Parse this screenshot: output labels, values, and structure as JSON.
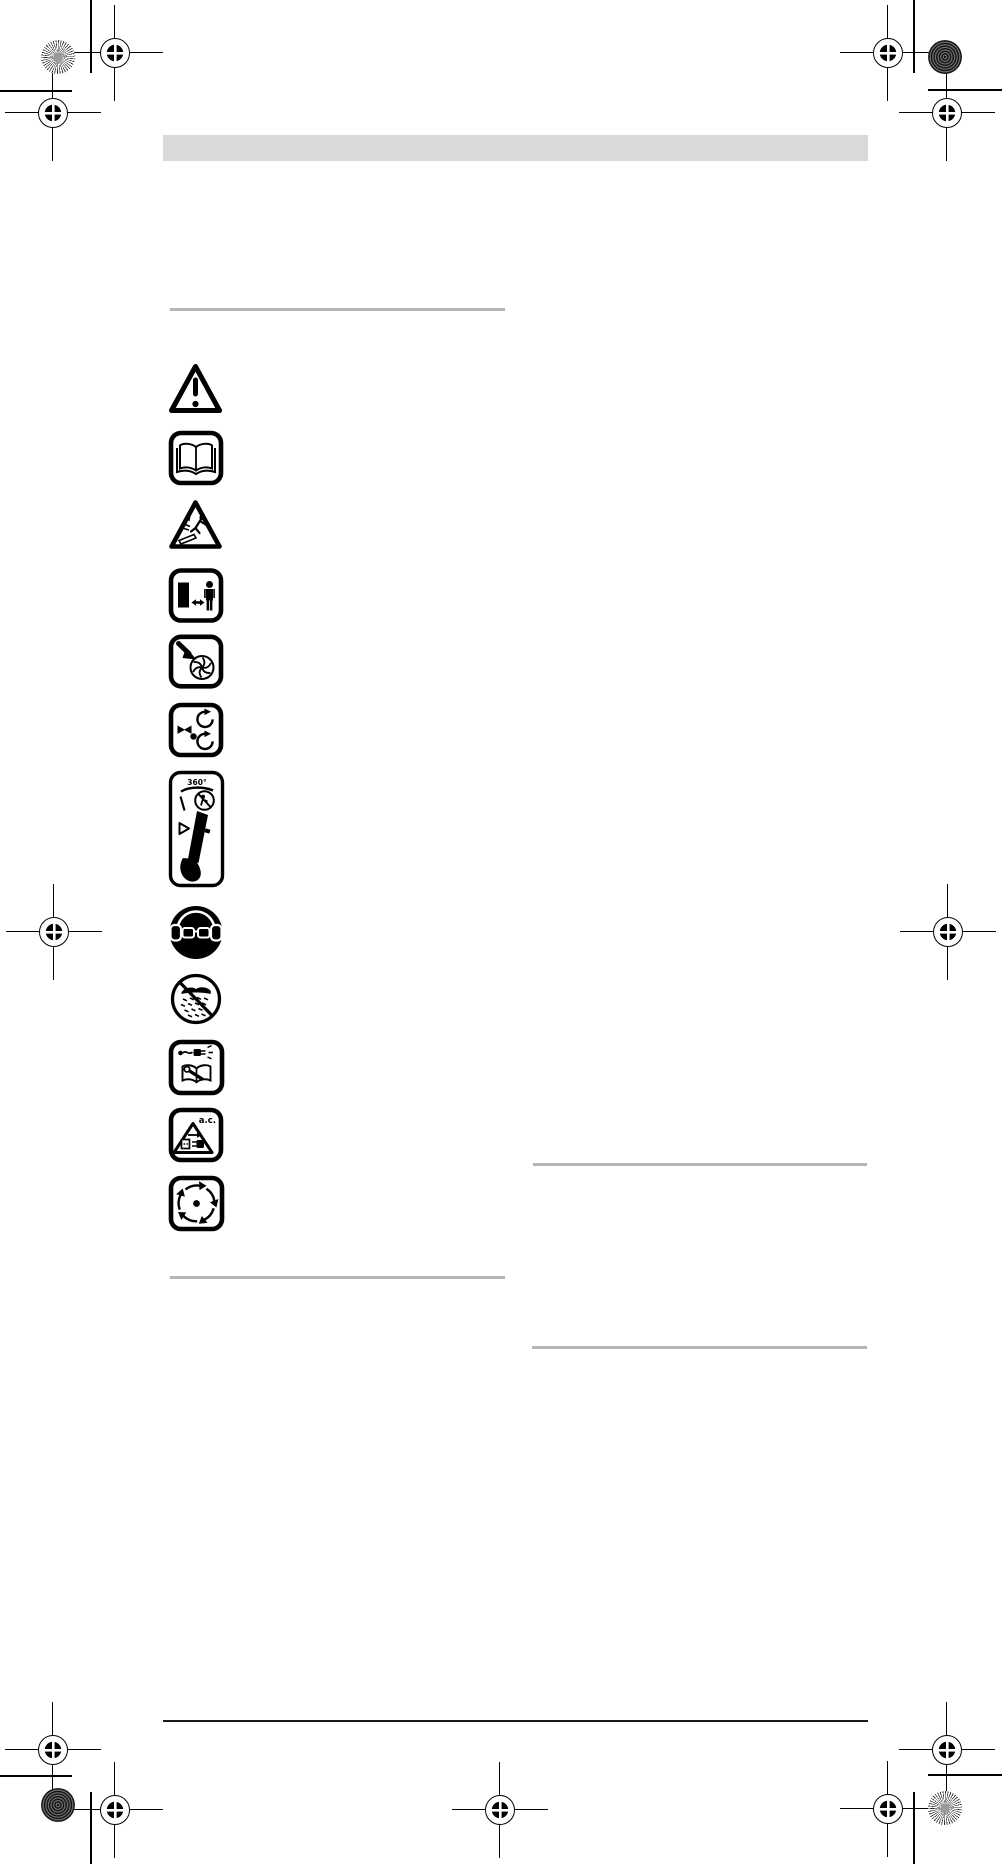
{
  "page": {
    "type": "instruction-manual-safety-symbols-page",
    "background": "#ffffff",
    "header_bar_color": "#d9d9d9",
    "rule_color": "#b5b5b5",
    "footer_rule_color": "#1a1a1a",
    "ink_color": "#000000"
  },
  "symbols": [
    {
      "id": "general-warning",
      "label": "general hazard warning triangle"
    },
    {
      "id": "read-manual",
      "label": "read the instruction manual"
    },
    {
      "id": "thrown-objects",
      "label": "beware of thrown objects"
    },
    {
      "id": "keep-bystanders-away",
      "label": "keep bystanders at a distance"
    },
    {
      "id": "rotating-fan-hand",
      "label": "danger rotating fan keep hands away"
    },
    {
      "id": "suction-debris",
      "label": "objects drawn in and rotating"
    },
    {
      "id": "blower-no-people-360",
      "label": "do not point blower at people in any direction",
      "text": "360°"
    },
    {
      "id": "eye-ear-protection",
      "label": "wear eye and hearing protection"
    },
    {
      "id": "no-rain",
      "label": "do not expose to rain"
    },
    {
      "id": "unplug-before-service",
      "label": "unplug and read manual before servicing"
    },
    {
      "id": "ac-disconnect",
      "label": "disconnect plug from a.c. mains if cord damaged",
      "text": "a.c."
    },
    {
      "id": "impeller-runs-on",
      "label": "rotating parts continue to run after switch off"
    }
  ],
  "print_marks": {
    "icon_names": [
      "registration-target-icon",
      "starburst-disc-icon",
      "moire-disc-icon",
      "crop-line"
    ]
  }
}
